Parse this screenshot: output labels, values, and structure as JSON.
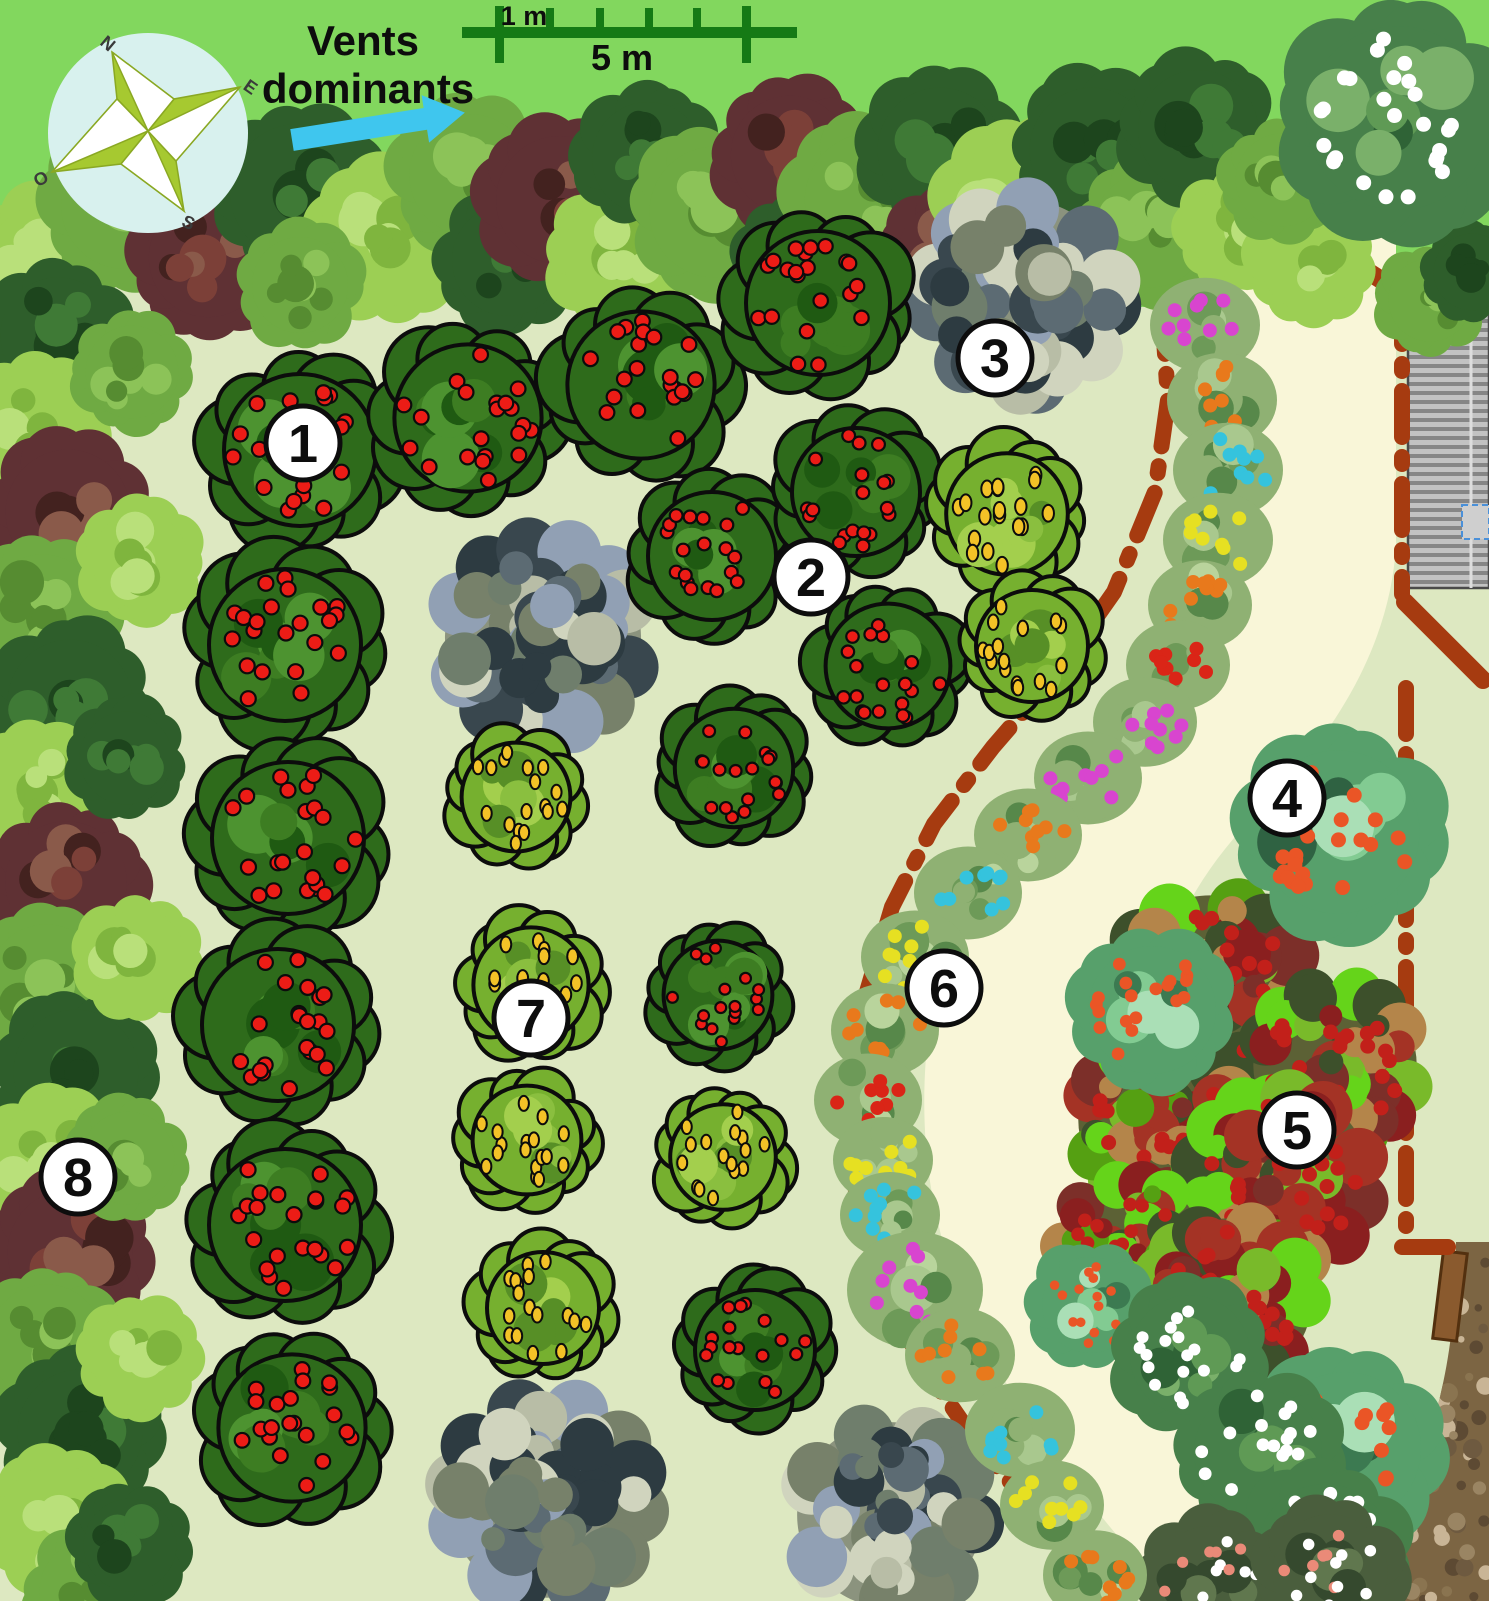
{
  "title": "Plan de verger (orchard plan)",
  "compass": {
    "n": "N",
    "e": "E",
    "s": "S",
    "o": "O"
  },
  "wind": {
    "line1": "Vents",
    "line2": "dominants"
  },
  "scale_bar": {
    "label_small": "1 m",
    "label_big": "5 m"
  },
  "colors": {
    "lawn": "#82d75e",
    "floor": "#dde8c1",
    "path": "#f9f6d8",
    "boundary": "#a63b10",
    "scale_green": "#157a15",
    "arrow_cyan": "#3fc6ee",
    "compass_disc": "#d8f1ee",
    "compass_star": "#a6c930",
    "soil": "#7c6543",
    "roof_light": "#c2c2c2",
    "roof_dark": "#868686"
  },
  "markers": [
    {
      "label": "1",
      "x": 303,
      "y": 443
    },
    {
      "label": "2",
      "x": 811,
      "y": 577
    },
    {
      "label": "3",
      "x": 995,
      "y": 358
    },
    {
      "label": "4",
      "x": 1287,
      "y": 798
    },
    {
      "label": "5",
      "x": 1297,
      "y": 1130
    },
    {
      "label": "6",
      "x": 944,
      "y": 988
    },
    {
      "label": "7",
      "x": 531,
      "y": 1018
    },
    {
      "label": "8",
      "x": 78,
      "y": 1177
    }
  ],
  "tree_styles": {
    "apple": {
      "base": "#2e6b1b",
      "edge": "#0c0c0c",
      "patches": [
        "#4d9330",
        "#1f5a12",
        "#3d7d22"
      ],
      "fruit": "#ec1c16",
      "fruit_stroke": "#0c0c0c",
      "fruit_shape": "circle"
    },
    "pear": {
      "base": "#76b02f",
      "edge": "#0c0c0c",
      "patches": [
        "#a3cf4d",
        "#578f26",
        "#8abf3f"
      ],
      "fruit": "#f3c227",
      "fruit_stroke": "#0c0c0c",
      "fruit_shape": "pear"
    },
    "walnut": {
      "base": "#8b937e",
      "mottled": true,
      "patches": [
        "#5c6b73",
        "#39474e",
        "#b8bda6",
        "#6f7e6c",
        "#91a0b4",
        "#2d3b41",
        "#d0d4be",
        "#77816a"
      ]
    },
    "teal": {
      "base": "#57a06b",
      "patches": [
        "#82cb92",
        "#3c7a51",
        "#aadfb6",
        "#2f6242"
      ],
      "fruit": "#ea5526",
      "fruit_shape": "circle"
    },
    "plum": {
      "base": "#5c6135",
      "mottled": true,
      "patches": [
        "#7c2f29",
        "#a43325",
        "#79ba2a",
        "#55a012",
        "#b4854a",
        "#3d502b",
        "#8a1f1f",
        "#65d41a"
      ],
      "fruit": "#c2201a",
      "fruit_shape": "circle"
    },
    "blossom": {
      "base": "#47804a",
      "patches": [
        "#5f9a55",
        "#2f6336",
        "#7ab06a"
      ],
      "fruit": "#ffffff",
      "fruit_shape": "circle"
    },
    "pinkblossom": {
      "base": "#4a5e3d",
      "patches": [
        "#35492e",
        "#60774e"
      ],
      "fruit": "#ffffff",
      "fruit2": "#ea8a78",
      "fruit_shape": "circle"
    },
    "hl": {
      "base": "#9ccf54",
      "patches": [
        "#b9e07a",
        "#7fb53e"
      ]
    },
    "hm": {
      "base": "#6faa43",
      "patches": [
        "#8cc358",
        "#568c31"
      ]
    },
    "hd": {
      "base": "#2e5e2b",
      "patches": [
        "#3f7a36",
        "#1d451d"
      ]
    },
    "hx": {
      "base": "#5f3134",
      "patches": [
        "#7c4038",
        "#43221f",
        "#8a5a4a"
      ]
    }
  },
  "hedges": [
    [
      45,
      262,
      72,
      "hl"
    ],
    [
      125,
      205,
      80,
      "hm"
    ],
    [
      208,
      258,
      74,
      "hx"
    ],
    [
      298,
      192,
      85,
      "hd"
    ],
    [
      388,
      242,
      80,
      "hl"
    ],
    [
      300,
      285,
      60,
      "hm"
    ],
    [
      470,
      175,
      76,
      "hm"
    ],
    [
      508,
      260,
      70,
      "hd"
    ],
    [
      560,
      200,
      80,
      "hx"
    ],
    [
      620,
      255,
      72,
      "hl"
    ],
    [
      648,
      158,
      70,
      "hd"
    ],
    [
      715,
      212,
      82,
      "hm"
    ],
    [
      790,
      155,
      74,
      "hx"
    ],
    [
      800,
      262,
      66,
      "hd"
    ],
    [
      872,
      200,
      84,
      "hm"
    ],
    [
      940,
      150,
      78,
      "hd"
    ],
    [
      952,
      255,
      68,
      "hx"
    ],
    [
      1022,
      205,
      84,
      "hl"
    ],
    [
      1092,
      150,
      78,
      "hd"
    ],
    [
      1150,
      230,
      72,
      "hm"
    ],
    [
      1198,
      130,
      75,
      "hd"
    ],
    [
      1238,
      230,
      60,
      "hl"
    ],
    [
      1310,
      262,
      62,
      "hl"
    ],
    [
      1282,
      180,
      58,
      "hm"
    ],
    [
      58,
      335,
      72,
      "hd"
    ],
    [
      36,
      425,
      68,
      "hl"
    ],
    [
      68,
      512,
      78,
      "hx"
    ],
    [
      42,
      612,
      72,
      "hm"
    ],
    [
      70,
      702,
      78,
      "hd"
    ],
    [
      36,
      792,
      66,
      "hl"
    ],
    [
      66,
      882,
      76,
      "hx"
    ],
    [
      46,
      982,
      72,
      "hm"
    ],
    [
      76,
      1072,
      78,
      "hd"
    ],
    [
      50,
      1162,
      72,
      "hl"
    ],
    [
      70,
      1252,
      78,
      "hx"
    ],
    [
      46,
      1342,
      72,
      "hm"
    ],
    [
      80,
      1432,
      78,
      "hd"
    ],
    [
      56,
      1522,
      72,
      "hl"
    ],
    [
      92,
      1592,
      66,
      "hm"
    ],
    [
      132,
      372,
      58,
      "hm"
    ],
    [
      140,
      560,
      60,
      "hl"
    ],
    [
      126,
      758,
      58,
      "hd"
    ],
    [
      138,
      958,
      60,
      "hl"
    ],
    [
      128,
      1158,
      58,
      "hm"
    ],
    [
      140,
      1358,
      60,
      "hl"
    ],
    [
      130,
      1545,
      58,
      "hd"
    ],
    [
      1430,
      300,
      52,
      "hm"
    ],
    [
      1472,
      272,
      48,
      "hd"
    ]
  ],
  "trees": [
    [
      "walnut",
      1023,
      296,
      112
    ],
    [
      "walnut",
      543,
      637,
      114
    ],
    [
      "walnut",
      547,
      1498,
      116
    ],
    [
      "walnut",
      890,
      1515,
      108
    ],
    [
      "apple",
      300,
      450,
      95
    ],
    [
      "apple",
      468,
      418,
      92
    ],
    [
      "apple",
      641,
      385,
      92
    ],
    [
      "apple",
      818,
      303,
      90
    ],
    [
      "apple",
      712,
      556,
      80
    ],
    [
      "apple",
      856,
      492,
      80
    ],
    [
      "apple",
      888,
      666,
      78
    ],
    [
      "apple",
      285,
      645,
      95
    ],
    [
      "apple",
      288,
      838,
      95
    ],
    [
      "apple",
      278,
      1025,
      95
    ],
    [
      "apple",
      285,
      1225,
      95
    ],
    [
      "apple",
      292,
      1428,
      92
    ],
    [
      "apple",
      734,
      768,
      74
    ],
    [
      "apple",
      718,
      995,
      68
    ],
    [
      "apple",
      755,
      1350,
      75
    ],
    [
      "pear",
      1007,
      514,
      76
    ],
    [
      "pear",
      1032,
      646,
      70
    ],
    [
      "pear",
      516,
      797,
      68
    ],
    [
      "pear",
      531,
      985,
      72
    ],
    [
      "pear",
      527,
      1140,
      68
    ],
    [
      "pear",
      543,
      1308,
      70
    ],
    [
      "pear",
      723,
      1157,
      66
    ],
    [
      "plum",
      1210,
      990,
      110
    ],
    [
      "plum",
      1335,
      1065,
      95
    ],
    [
      "plum",
      1160,
      1120,
      95
    ],
    [
      "plum",
      1280,
      1180,
      105
    ],
    [
      "plum",
      1130,
      1250,
      85
    ],
    [
      "plum",
      1230,
      1300,
      95
    ],
    [
      "teal",
      1338,
      832,
      102
    ],
    [
      "teal",
      1152,
      1010,
      80
    ],
    [
      "teal",
      1090,
      1305,
      60
    ],
    [
      "teal",
      1345,
      1448,
      95
    ],
    [
      "blossom",
      1398,
      118,
      115
    ],
    [
      "blossom",
      1190,
      1355,
      75
    ],
    [
      "blossom",
      1258,
      1452,
      80
    ],
    [
      "blossom",
      1325,
      1552,
      85
    ],
    [
      "pinkblossom",
      1210,
      1582,
      70
    ],
    [
      "pinkblossom",
      1330,
      1572,
      72
    ]
  ],
  "flower_colors": {
    "m": "#d845cf",
    "o": "#e8791c",
    "c": "#35c3dd",
    "y": "#e6e022",
    "r": "#da2517"
  },
  "flower_strip": [
    [
      1205,
      325,
      "m",
      55
    ],
    [
      1222,
      400,
      "o",
      55
    ],
    [
      1228,
      470,
      "c",
      55
    ],
    [
      1218,
      540,
      "y",
      55
    ],
    [
      1200,
      605,
      "o",
      52
    ],
    [
      1178,
      665,
      "r",
      52
    ],
    [
      1145,
      722,
      "m",
      52
    ],
    [
      1088,
      778,
      "m",
      54
    ],
    [
      1028,
      835,
      "o",
      54
    ],
    [
      968,
      893,
      "c",
      54
    ],
    [
      915,
      957,
      "y",
      54
    ],
    [
      885,
      1030,
      "o",
      54
    ],
    [
      868,
      1100,
      "r",
      54
    ],
    [
      883,
      1160,
      "y",
      50
    ],
    [
      890,
      1215,
      "c",
      50
    ],
    [
      915,
      1290,
      "m",
      68
    ],
    [
      960,
      1355,
      "o",
      55
    ],
    [
      1020,
      1430,
      "c",
      55
    ],
    [
      1052,
      1505,
      "y",
      52
    ],
    [
      1095,
      1575,
      "o",
      52
    ]
  ],
  "boundaries": {
    "dash_dot": [
      [
        [
          1162,
          308
        ],
        [
          1168,
          400
        ],
        [
          1155,
          492
        ],
        [
          1114,
          592
        ],
        [
          1058,
          672
        ],
        [
          993,
          747
        ],
        [
          934,
          824
        ],
        [
          892,
          907
        ],
        [
          864,
          1002
        ],
        [
          852,
          1097
        ],
        [
          856,
          1192
        ],
        [
          880,
          1282
        ],
        [
          921,
          1362
        ],
        [
          976,
          1442
        ],
        [
          1036,
          1512
        ],
        [
          1092,
          1572
        ],
        [
          1116,
          1601
        ]
      ],
      [
        [
          1402,
          298
        ],
        [
          1402,
          594
        ]
      ],
      [
        [
          1406,
          688
        ],
        [
          1406,
          1240
        ]
      ],
      [
        [
          1402,
          1247
        ],
        [
          1448,
          1247
        ]
      ]
    ],
    "solid_dashes": [
      [
        [
          1243,
          248
        ],
        [
          1294,
          272
        ]
      ],
      [
        [
          1322,
          242
        ],
        [
          1400,
          292
        ]
      ],
      [
        [
          1405,
          602
        ],
        [
          1483,
          680
        ]
      ]
    ]
  }
}
